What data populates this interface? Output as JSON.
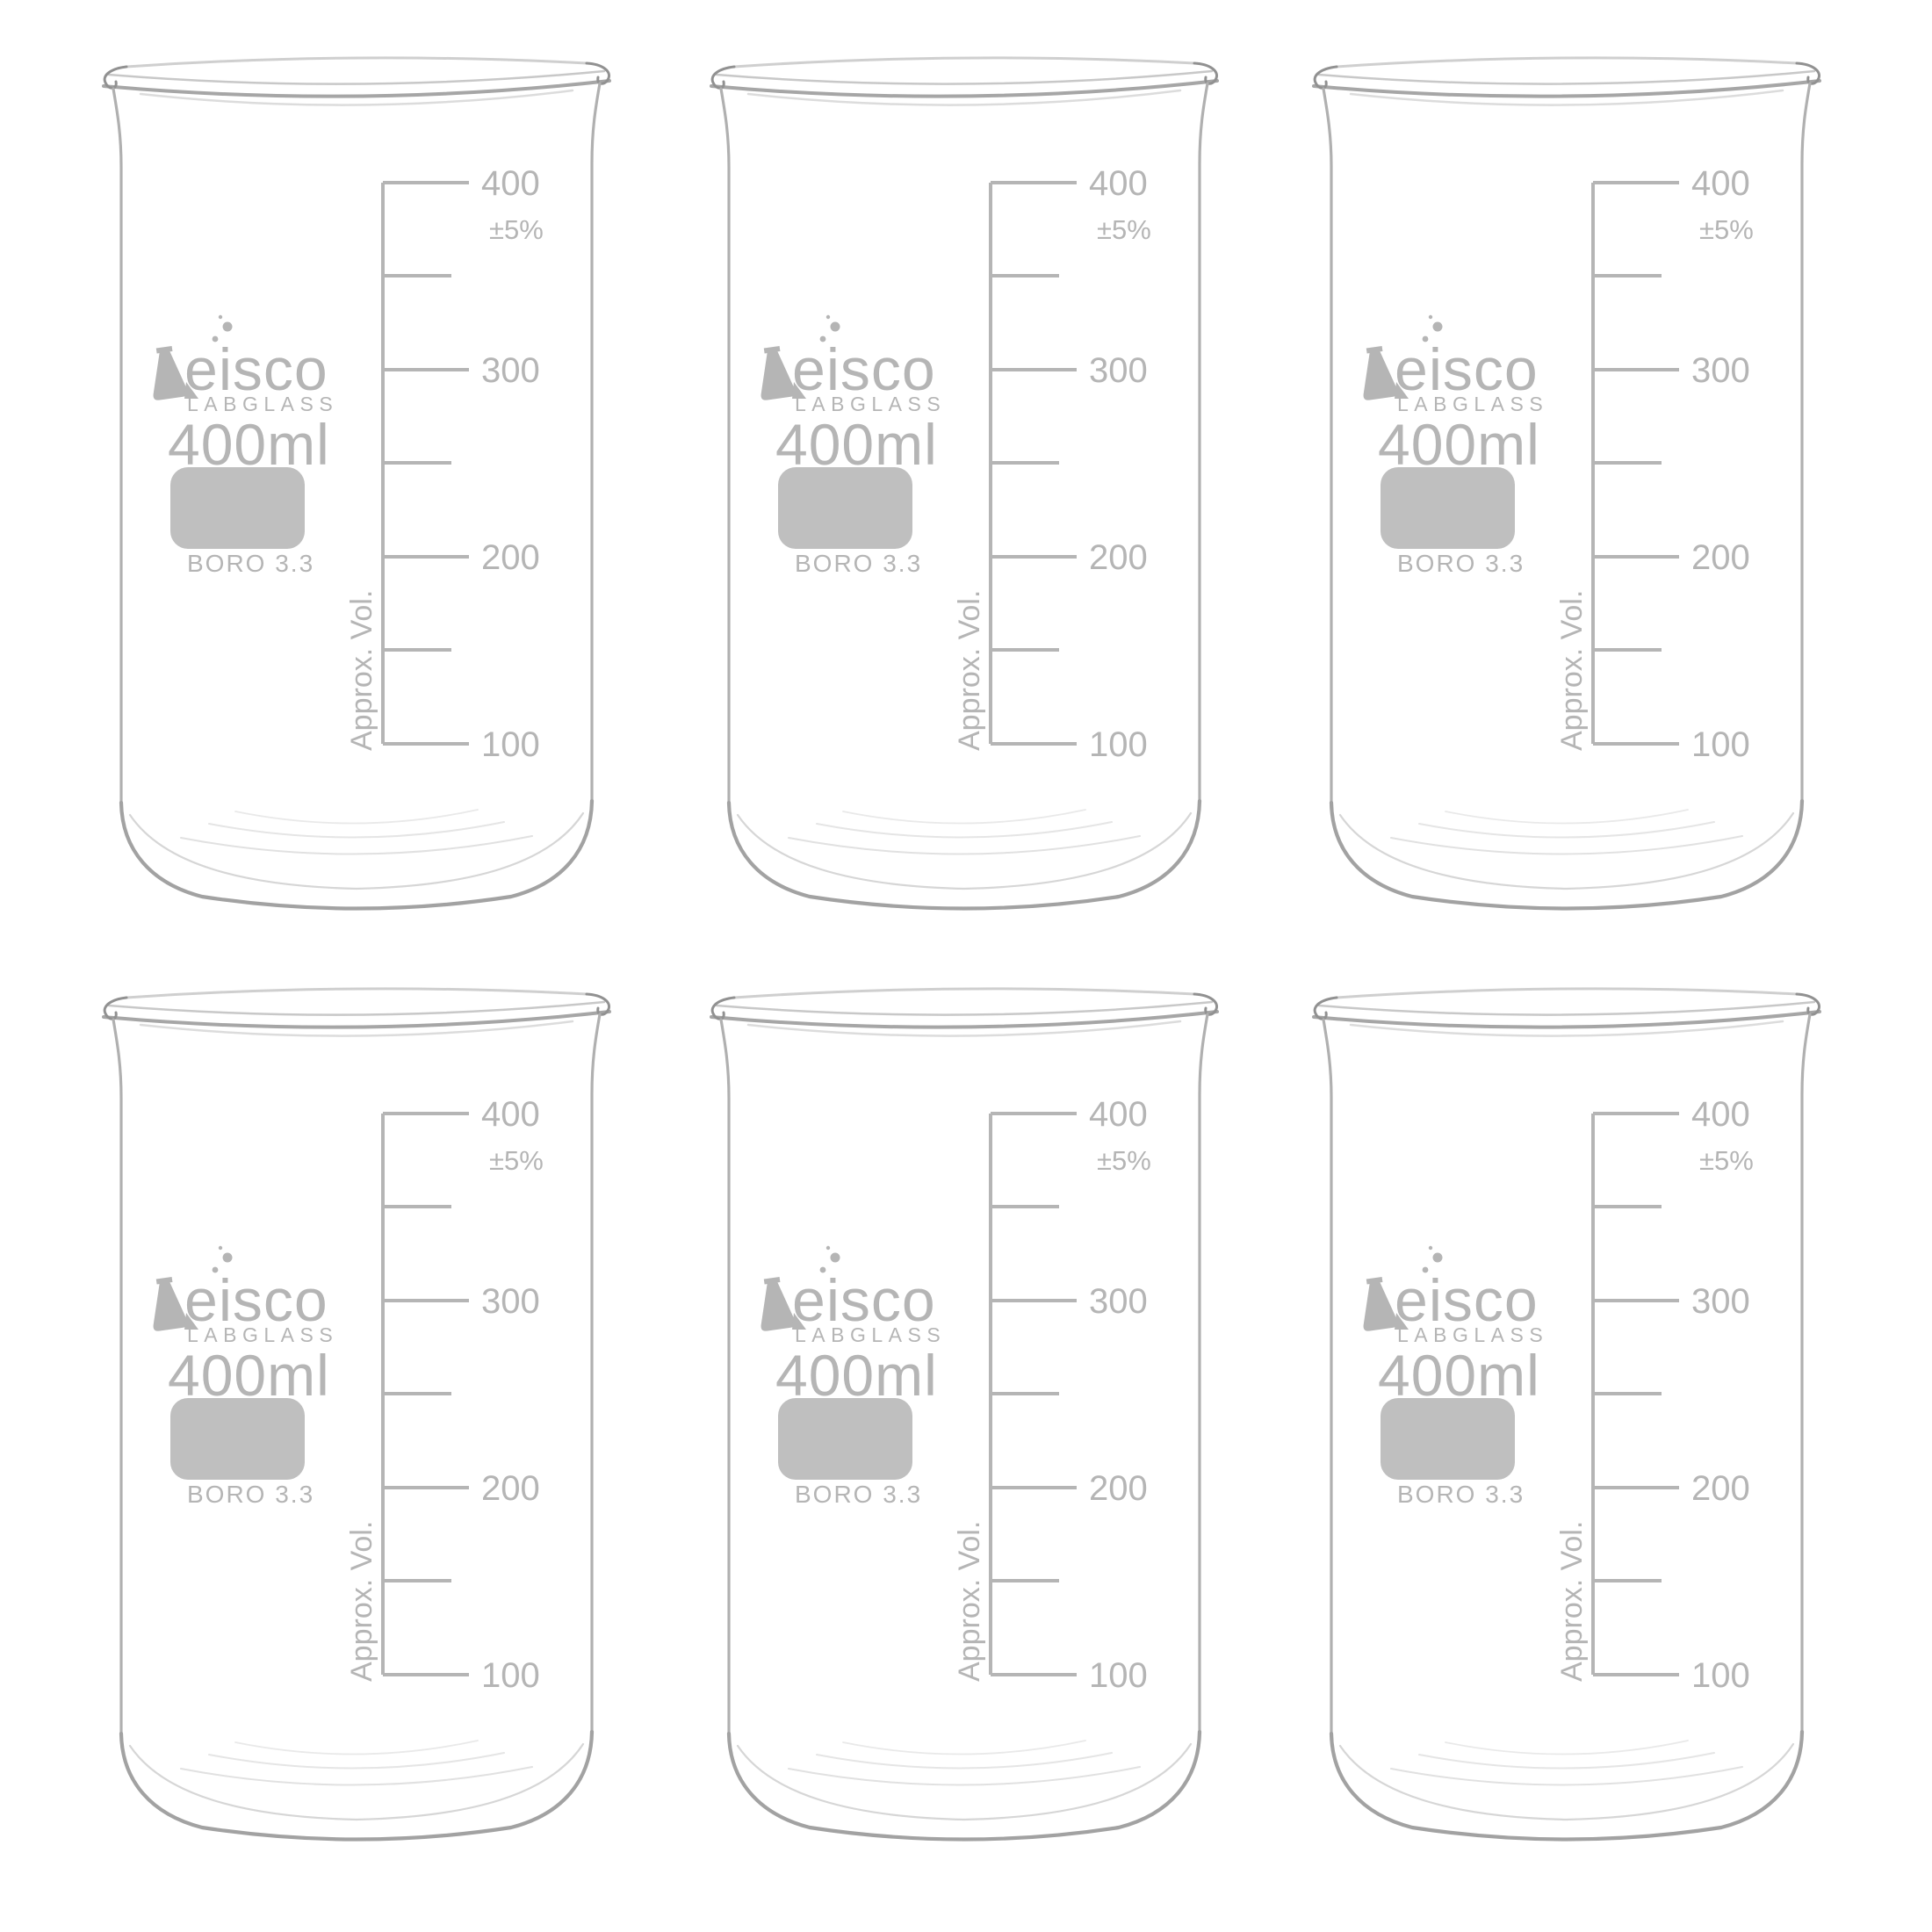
{
  "photo": {
    "background": "#ffffff"
  },
  "layout": {
    "rows": 2,
    "cols": 3,
    "count": 6
  },
  "product": {
    "brand": "eisco",
    "series": "LABGLASS",
    "capacity": "400ml",
    "material": "BORO 3.3",
    "tolerance": "±5%",
    "approx_vol": "Approx. Vol.",
    "scale": {
      "unit": "ml",
      "labels": [
        "400",
        "300",
        "200",
        "100"
      ],
      "values": [
        400,
        300,
        200,
        100
      ],
      "minor_ticks": [
        350,
        250,
        150
      ]
    }
  },
  "icons": {
    "brand_mark": "erlenmeyer-flask-icon",
    "brand_bubbles": "bubbles-icon"
  },
  "colors": {
    "print": "#b5b5b5",
    "marking_area_fill": "#bfbfbf",
    "glass_line": "#b0b0b0",
    "glass_dark": "#919191",
    "glass_light": "#dcdcdc",
    "background": "#ffffff"
  }
}
